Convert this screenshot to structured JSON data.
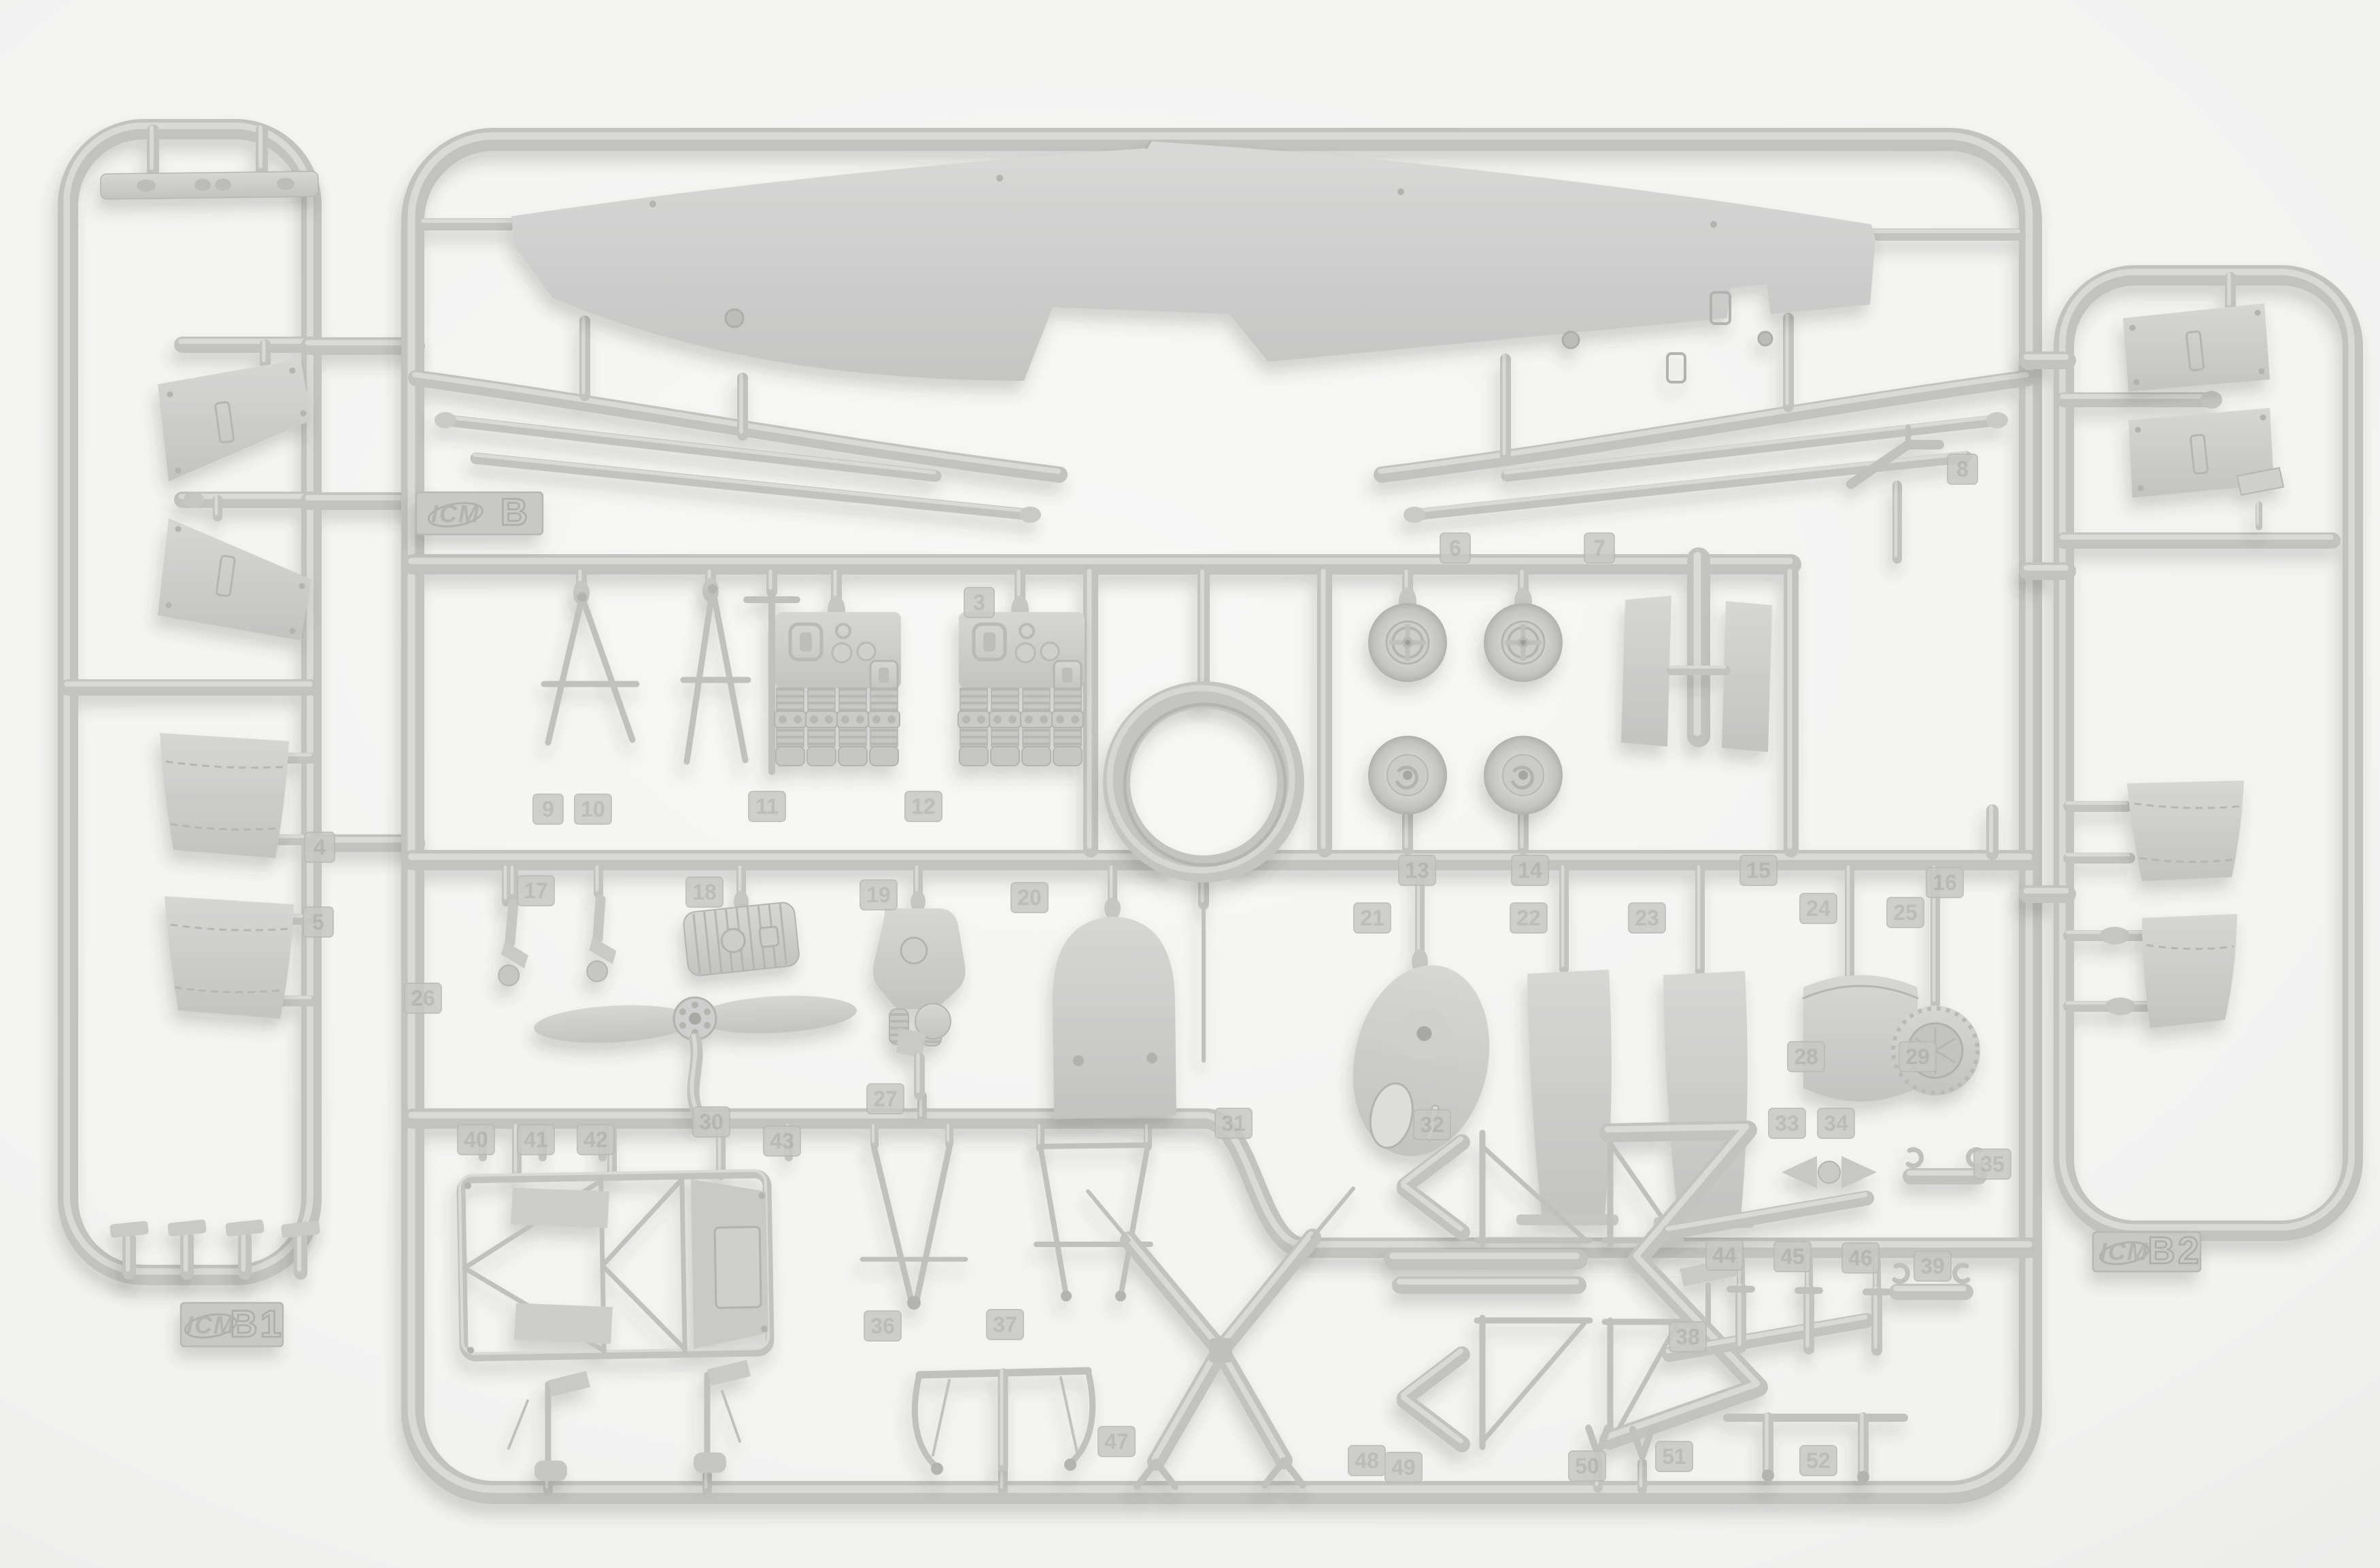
{
  "scene_type": "photograph of plastic model kit sprues",
  "sprues": {
    "left": {
      "brand": "ICM",
      "label": "B1"
    },
    "center": {
      "brand": "ICM",
      "label": "B"
    },
    "right": {
      "brand": "ICM",
      "label": "B2"
    }
  },
  "part_numbers": [
    "3",
    "4",
    "5",
    "6",
    "7",
    "8",
    "9",
    "10",
    "11",
    "12",
    "13",
    "14",
    "15",
    "16",
    "17",
    "18",
    "19",
    "20",
    "21",
    "22",
    "23",
    "24",
    "25",
    "26",
    "27",
    "28",
    "29",
    "30",
    "31",
    "32",
    "33",
    "34",
    "35",
    "36",
    "37",
    "38",
    "39",
    "40",
    "41",
    "42",
    "43",
    "44",
    "45",
    "46",
    "47",
    "48",
    "49",
    "50",
    "51",
    "52"
  ],
  "parts_inventory": [
    "upper-wing",
    "interplane-strut-rods",
    "cabane-struts",
    "engine-block-halves",
    "spoked-main-wheels",
    "disc-wheel-halves",
    "twin-panel-radiator",
    "cowling-ring",
    "two-blade-propeller",
    "fuselage-truss-frame",
    "landing-gear-v-struts",
    "landing-gear-x-strut",
    "exhaust-zigzag-pipes",
    "tail-skid-parts",
    "cowling-side-panels",
    "fuselage-side-panels",
    "walkway-strip",
    "seat-and-tank-halves",
    "windshield",
    "control-horns",
    "small-fittings"
  ],
  "colors": {
    "background": "#f2f2f1",
    "plastic": "#c6c6c5",
    "plastic_light": "#d9d9d8",
    "plastic_dark": "#aeaead",
    "shadow": "rgba(70,70,70,0.20)"
  }
}
